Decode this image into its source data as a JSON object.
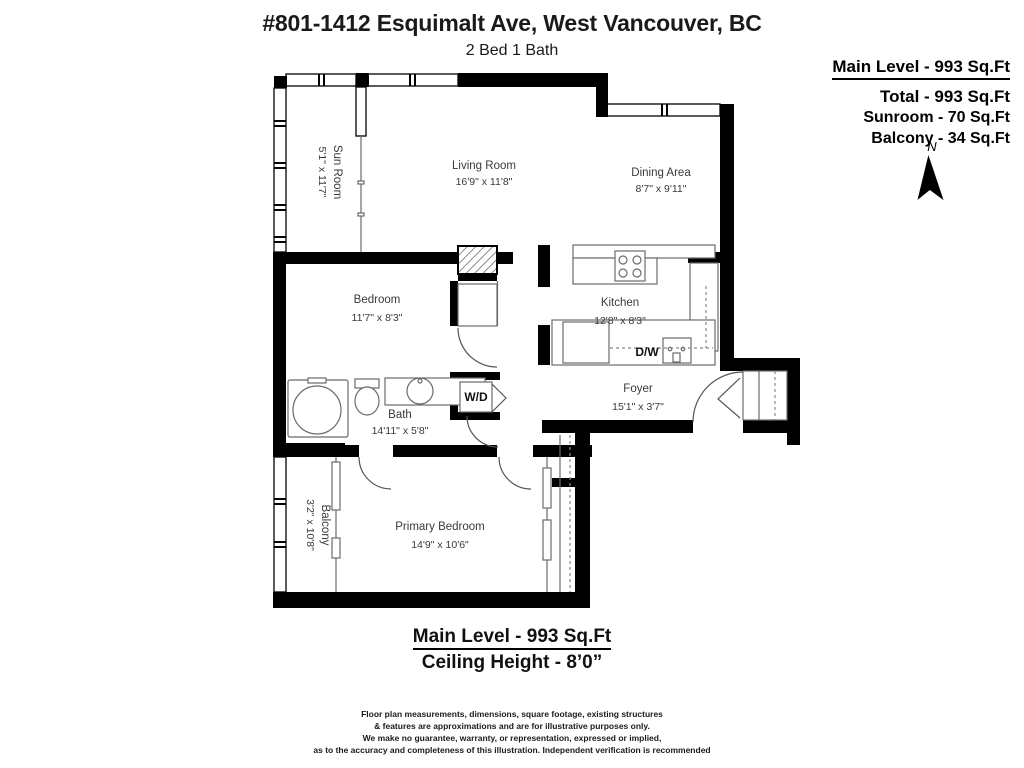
{
  "header": {
    "title": "#801-1412 Esquimalt Ave, West Vancouver, BC",
    "subtitle": "2 Bed 1 Bath"
  },
  "area_summary": {
    "main_level": "Main Level - 993 Sq.Ft",
    "total": "Total - 993 Sq.Ft",
    "sunroom": "Sunroom - 70 Sq.Ft",
    "balcony": "Balcony - 34 Sq.Ft"
  },
  "compass": {
    "label": "N"
  },
  "rooms": [
    {
      "id": "sun-room",
      "name": "Sun Room",
      "dims": "5'1\" x 11'7\""
    },
    {
      "id": "living-room",
      "name": "Living Room",
      "dims": "16'9\" x 11'8\""
    },
    {
      "id": "dining-area",
      "name": "Dining Area",
      "dims": "8'7\" x 9'11\""
    },
    {
      "id": "bedroom",
      "name": "Bedroom",
      "dims": "11'7\" x 8'3\""
    },
    {
      "id": "kitchen",
      "name": "Kitchen",
      "dims": "12'8\" x 8'3\""
    },
    {
      "id": "bath",
      "name": "Bath",
      "dims": "14'11\" x 5'8\""
    },
    {
      "id": "foyer",
      "name": "Foyer",
      "dims": "15'1\" x 3'7\""
    },
    {
      "id": "primary-bedroom",
      "name": "Primary Bedroom",
      "dims": "14'9\" x 10'6\""
    },
    {
      "id": "balcony",
      "name": "Balcony",
      "dims": "3'2\" x 10'8\""
    }
  ],
  "appliances": {
    "dishwasher": "D/W",
    "washer_dryer": "W/D"
  },
  "footer": {
    "main_level": "Main Level - 993 Sq.Ft",
    "ceiling": "Ceiling Height - 8’0”"
  },
  "disclaimer": {
    "lines": [
      "Floor plan measurements, dimensions, square footage, existing structures",
      "& features are approximations and are for illustrative purposes only.",
      "We make no guarantee, warranty, or representation, expressed or implied,",
      "as to the accuracy and completeness of this illustration. Independent verification is recommended"
    ]
  },
  "colors": {
    "wall": "#000000",
    "label_text": "#3a3a3a"
  }
}
